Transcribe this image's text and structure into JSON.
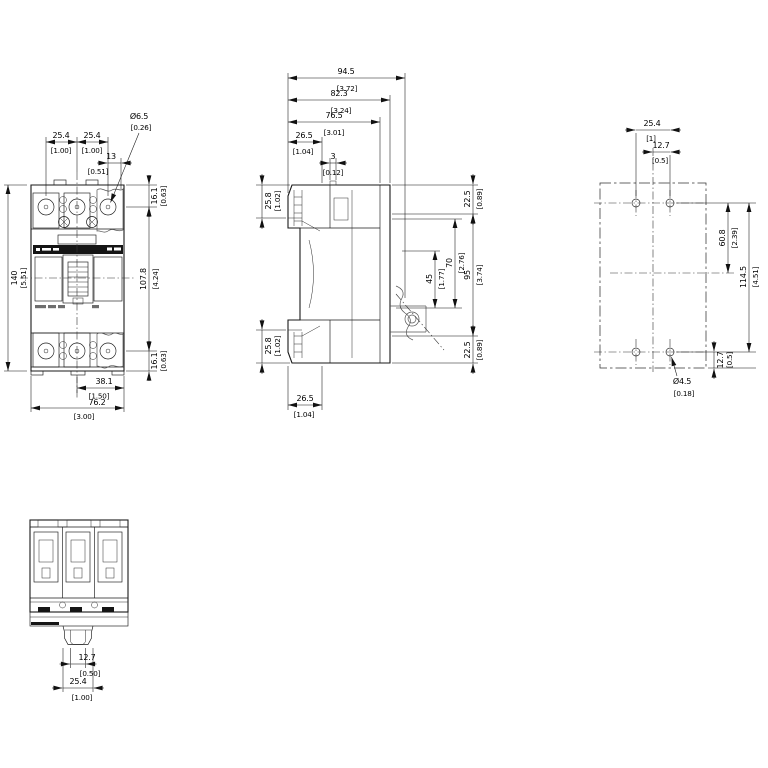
{
  "drawing": {
    "front": {
      "pitch1": {
        "mm": "25.4",
        "in": "[1.00]"
      },
      "pitch2": {
        "mm": "25.4",
        "in": "[1.00]"
      },
      "term_hole": {
        "mm": "Ø6.5",
        "in": "[0.26]"
      },
      "offset": {
        "mm": "13",
        "in": "[0.51]"
      },
      "top_edge": {
        "mm": "16.1",
        "in": "[0.63]"
      },
      "height": {
        "mm": "140",
        "in": "[5.51]"
      },
      "center_height": {
        "mm": "107.8",
        "in": "[4.24]"
      },
      "bottom_edge": {
        "mm": "16.1",
        "in": "[0.63]"
      },
      "half_width": {
        "mm": "38.1",
        "in": "[1.50]"
      },
      "width": {
        "mm": "76.2",
        "in": "[3.00]"
      }
    },
    "side": {
      "depth_overall": {
        "mm": "94.5",
        "in": "[3.72]"
      },
      "depth_mount": {
        "mm": "82.3",
        "in": "[3.24]"
      },
      "depth_body": {
        "mm": "76.5",
        "in": "[3.01]"
      },
      "front_top": {
        "mm": "26.5",
        "in": "[1.04]"
      },
      "rib": {
        "mm": "3",
        "in": "[0.12]"
      },
      "term_top": {
        "mm": "25.8",
        "in": "[1.02]"
      },
      "term_bottom": {
        "mm": "25.8",
        "in": "[1.02]"
      },
      "rear_top": {
        "mm": "22.5",
        "in": "[0.89]"
      },
      "slot45": {
        "mm": "45",
        "in": "[1.77]"
      },
      "slot70": {
        "mm": "70",
        "in": "[2.76]"
      },
      "rear_span": {
        "mm": "95",
        "in": "[3.74]"
      },
      "rear_bottom": {
        "mm": "22.5",
        "in": "[0.89]"
      },
      "front_bottom": {
        "mm": "26.5",
        "in": "[1.04]"
      }
    },
    "plan": {
      "hole_pitch": {
        "mm": "25.4",
        "in": "[1]"
      },
      "hole_half": {
        "mm": "12.7",
        "in": "[0.5]"
      },
      "upper_span": {
        "mm": "60.8",
        "in": "[2.39]"
      },
      "hole_span": {
        "mm": "114.5",
        "in": "[4.51]"
      },
      "bottom_edge": {
        "mm": "12.7",
        "in": "[0.5]"
      },
      "hole_dia": {
        "mm": "Ø4.5",
        "in": "[0.18]"
      }
    },
    "bottom": {
      "slot": {
        "mm": "12.7",
        "in": "[0.50]"
      },
      "tab": {
        "mm": "25.4",
        "in": "[1.00]"
      }
    }
  }
}
